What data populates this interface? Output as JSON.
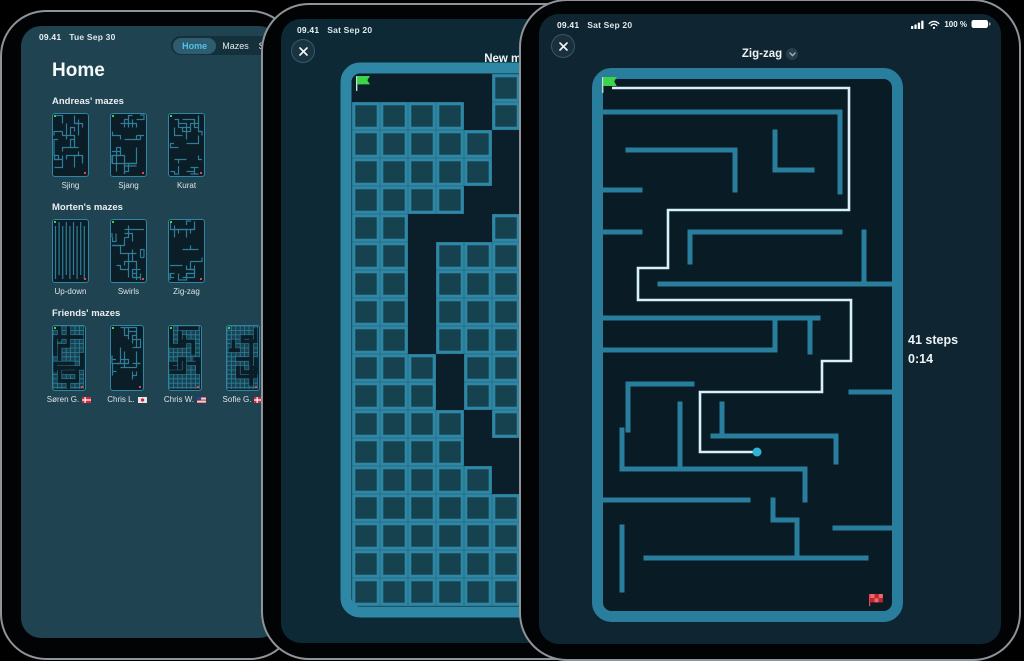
{
  "colors": {
    "accent_teal": "#2a7e9d",
    "path_light": "#d7f0fb",
    "player_dot": "#2fb4d4",
    "start_green": "#3fd24b",
    "goal_red": "#e8434c",
    "tab_selected_text": "#55c1ea"
  },
  "home": {
    "status": {
      "time": "09.41",
      "date": "Tue Sep 30"
    },
    "tabs": [
      {
        "label": "Home",
        "selected": true
      },
      {
        "label": "Mazes",
        "selected": false
      },
      {
        "label": "S",
        "selected": false
      }
    ],
    "title": "Home",
    "sections": [
      {
        "header": "Andreas' mazes",
        "items": [
          {
            "label": "Sjing",
            "variant": "lines",
            "seed": 11
          },
          {
            "label": "Sjang",
            "variant": "lines",
            "seed": 22
          },
          {
            "label": "Kurat",
            "variant": "lines",
            "seed": 33
          }
        ]
      },
      {
        "header": "Morten's mazes",
        "items": [
          {
            "label": "Up-down",
            "variant": "updown",
            "seed": 44
          },
          {
            "label": "Swirls",
            "variant": "lines",
            "seed": 55
          },
          {
            "label": "Zig-zag",
            "variant": "lines",
            "seed": 66
          }
        ]
      },
      {
        "header": "Friends' mazes",
        "items": [
          {
            "label": "Søren G.",
            "flag": "dk",
            "variant": "carved",
            "seed": 77
          },
          {
            "label": "Chris L.",
            "flag": "jp",
            "variant": "lines",
            "seed": 88
          },
          {
            "label": "Chris W.",
            "flag": "us",
            "variant": "carved",
            "seed": 99
          },
          {
            "label": "Sofie G.",
            "flag": "dk",
            "variant": "carved",
            "seed": 111
          }
        ]
      }
    ]
  },
  "editor": {
    "status": {
      "time": "09.41",
      "date": "Sat Sep 20"
    },
    "title": "New maze",
    "grid": {
      "cols": 10,
      "rows": 19,
      "cell": 28,
      "origin": [
        352,
        74
      ],
      "frame": [
        346,
        68,
        292,
        544
      ],
      "map": [
        "EEEEEFFFFF",
        "FFFFEFFFFF",
        "FFFFFEFFFF",
        "FFFFFEFFFF",
        "FFFFEEFFFF",
        "FFEEEFFFFF",
        "FFEFFFFFFF",
        "FFEFFFFFFF",
        "FFEFFFFFFF",
        "FFEFFFFFFF",
        "FFFEFFFFFF",
        "FFFEFFFFFF",
        "FFFFEFFFFF",
        "FFFFEEFFFF",
        "FFFFFEEFFF",
        "FFFFFFFFFF",
        "FFFFFFFFFF",
        "FFFFFFFFFF",
        "FFFFFFFFFF"
      ],
      "start_flag": [
        356,
        76
      ]
    }
  },
  "play": {
    "status": {
      "time": "09.41",
      "date": "Sat Sep 20",
      "battery": "100 %"
    },
    "title": "Zig-zag",
    "hud": {
      "steps": "41 steps",
      "time": "0:14"
    },
    "maze": {
      "outer": [
        597.5,
        73.5,
        300,
        543
      ],
      "walls": [
        [
          598,
          112,
          840,
          112
        ],
        [
          840,
          112,
          840,
          192
        ],
        [
          628,
          150,
          735,
          150
        ],
        [
          735,
          150,
          735,
          190
        ],
        [
          775,
          132,
          775,
          170
        ],
        [
          775,
          170,
          812,
          170
        ],
        [
          598,
          190,
          640,
          190
        ],
        [
          598,
          232,
          640,
          232
        ],
        [
          690,
          232,
          840,
          232
        ],
        [
          690,
          232,
          690,
          262
        ],
        [
          864,
          232,
          864,
          284
        ],
        [
          660,
          284,
          890,
          284
        ],
        [
          598,
          318,
          818,
          318
        ],
        [
          775,
          318,
          775,
          350
        ],
        [
          598,
          350,
          775,
          350
        ],
        [
          810,
          318,
          810,
          352
        ],
        [
          628,
          384,
          692,
          384
        ],
        [
          628,
          384,
          628,
          430
        ],
        [
          680,
          404,
          680,
          469
        ],
        [
          722,
          404,
          722,
          436
        ],
        [
          713,
          436,
          836,
          436
        ],
        [
          836,
          436,
          836,
          462
        ],
        [
          851,
          392,
          890,
          392
        ],
        [
          622,
          430,
          622,
          469
        ],
        [
          622,
          469,
          805,
          469
        ],
        [
          805,
          469,
          805,
          500
        ],
        [
          598,
          500,
          748,
          500
        ],
        [
          773,
          500,
          773,
          520
        ],
        [
          773,
          520,
          797,
          520
        ],
        [
          797,
          520,
          797,
          556
        ],
        [
          835,
          528,
          890,
          528
        ],
        [
          622,
          527,
          622,
          590
        ],
        [
          646,
          558,
          866,
          558
        ]
      ],
      "path": [
        [
          612,
          88
        ],
        [
          849,
          88
        ],
        [
          849,
          210
        ],
        [
          668,
          210
        ],
        [
          668,
          268
        ],
        [
          638,
          268
        ],
        [
          638,
          300
        ],
        [
          851,
          300
        ],
        [
          851,
          361
        ],
        [
          822,
          361
        ],
        [
          822,
          392
        ],
        [
          700,
          392
        ],
        [
          700,
          452
        ],
        [
          757,
          452
        ]
      ],
      "dot": [
        757,
        452
      ],
      "start_flag": [
        602,
        77
      ],
      "goal_flag": [
        869,
        594
      ]
    }
  }
}
